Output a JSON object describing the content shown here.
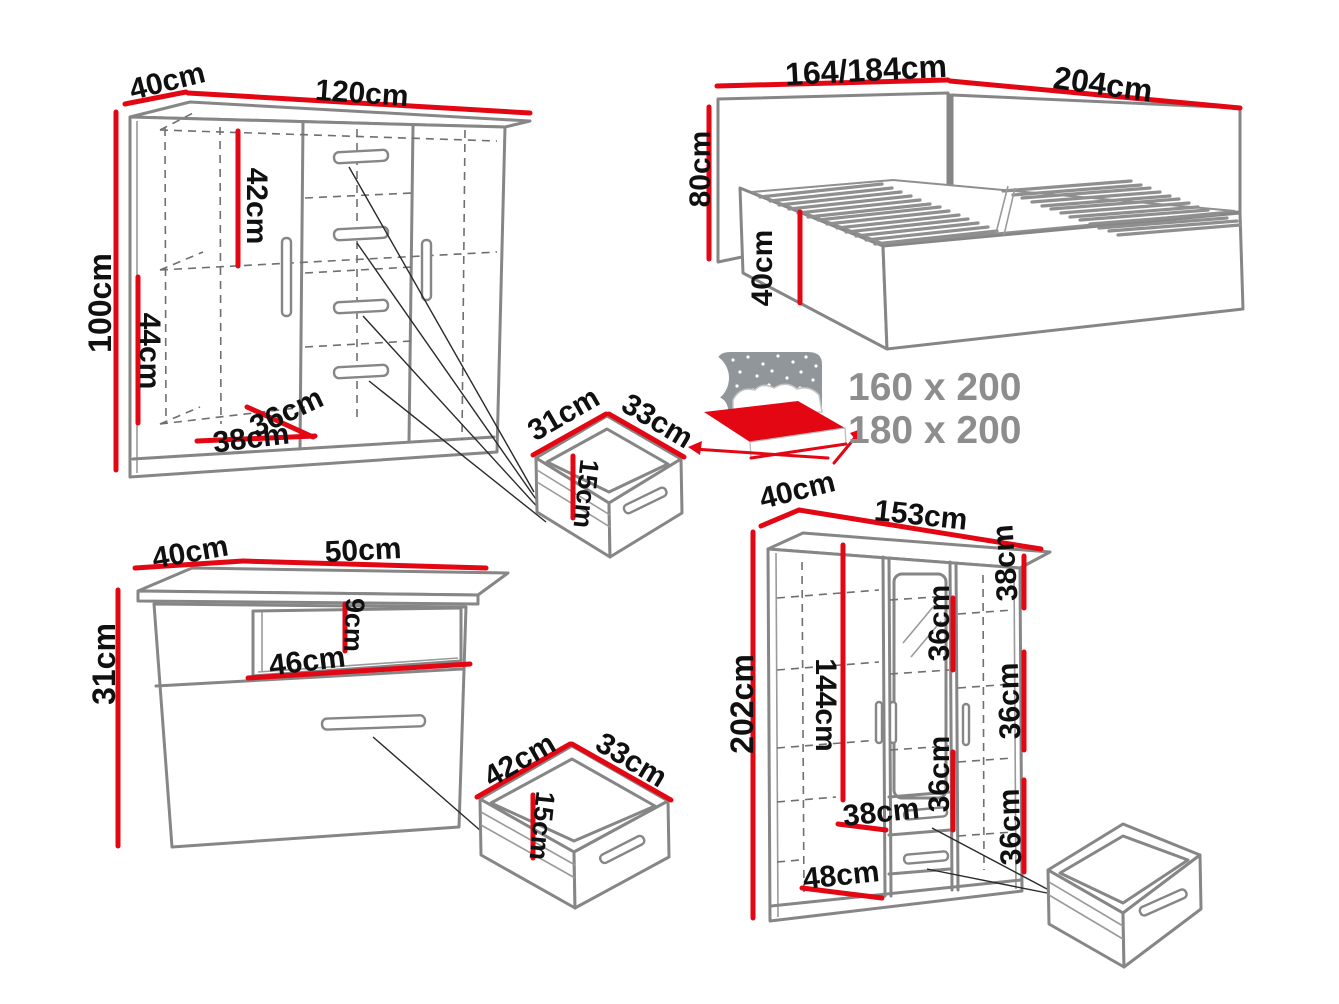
{
  "palette": {
    "red": "#e30613",
    "outline": "#868686",
    "dashed_line": "#6f6f6f",
    "label_text": "#101010",
    "muted_text": "#8d8d8d"
  },
  "chest": {
    "depth": "40cm",
    "width": "120cm",
    "height": "100cm",
    "inner_top_height": "42cm",
    "inner_bottom_height": "44cm",
    "inner_depth": "36cm",
    "inner_width": "38cm"
  },
  "bed": {
    "width": "164/184cm",
    "length": "204cm",
    "headboard_height": "80cm",
    "base_height": "40cm",
    "mattress_size_1": "160 x 200",
    "mattress_size_2": "180 x 200"
  },
  "drawer_small": {
    "width": "31cm",
    "depth": "33cm",
    "height": "15cm"
  },
  "nightstand": {
    "depth": "40cm",
    "width": "50cm",
    "height": "31cm",
    "niche_height": "9cm",
    "niche_width": "46cm"
  },
  "drawer_medium": {
    "width": "42cm",
    "depth": "33cm",
    "height": "15cm"
  },
  "wardrobe": {
    "depth": "40cm",
    "width": "153cm",
    "height": "202cm",
    "hanging_height": "144cm",
    "top_right_shelf_height": "38cm",
    "middle_shelf_1": "36cm",
    "middle_shelf_2": "36cm",
    "right_shelf_1": "36cm",
    "right_shelf_2": "36cm",
    "left_shelf_width": "38cm",
    "bottom_width": "48cm"
  }
}
